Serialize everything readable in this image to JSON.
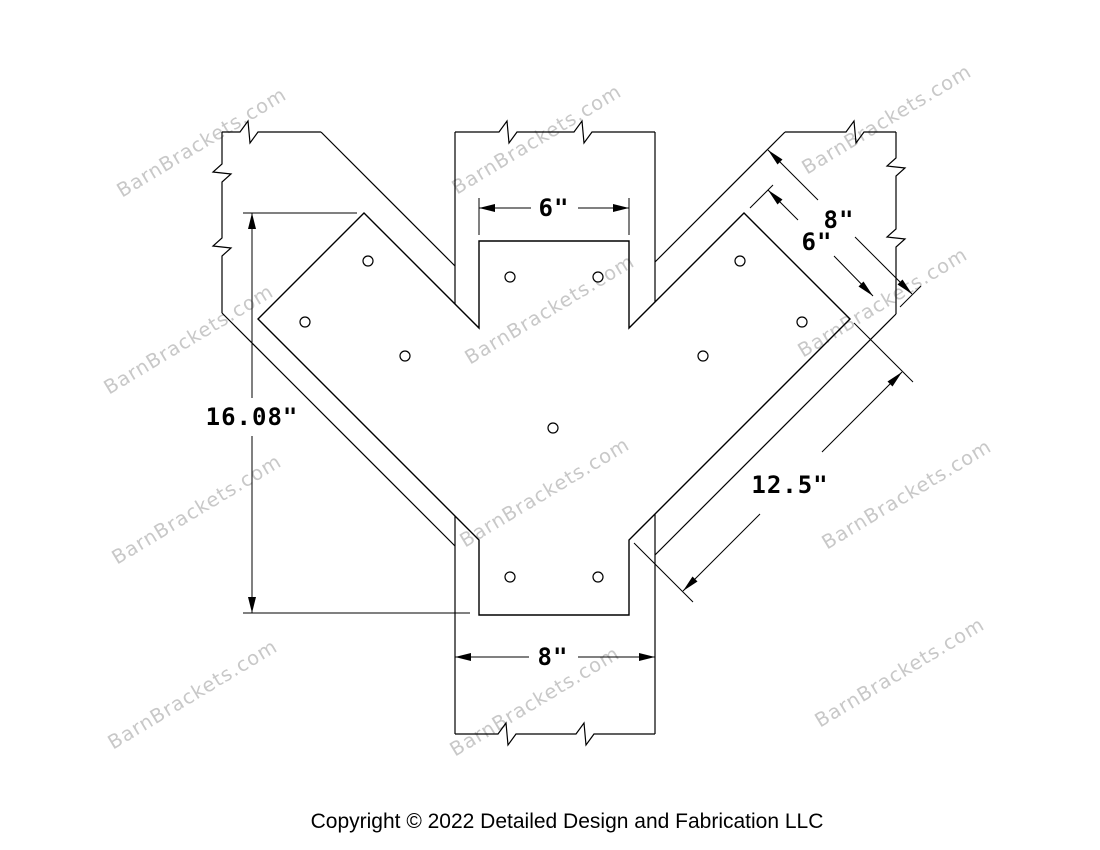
{
  "watermark": {
    "text": "BarnBrackets.com",
    "color": "#c8c8c8"
  },
  "footer": {
    "copyright": "Copyright © 2022 Detailed Design and Fabrication LLC"
  },
  "colors": {
    "background": "#ffffff",
    "line": "#000000"
  },
  "dimensions": {
    "plate_top_width": {
      "label": "6\"",
      "inches": 6
    },
    "post_width": {
      "label": "8\"",
      "inches": 8
    },
    "plate_left_height": {
      "label": "16.08\"",
      "inches": 16.08
    },
    "arm_length": {
      "label": "12.5\"",
      "inches": 12.5
    },
    "beam_width": {
      "label": "8\"",
      "inches": 8
    },
    "arm_plate_width": {
      "label": "6\"",
      "inches": 6
    }
  }
}
